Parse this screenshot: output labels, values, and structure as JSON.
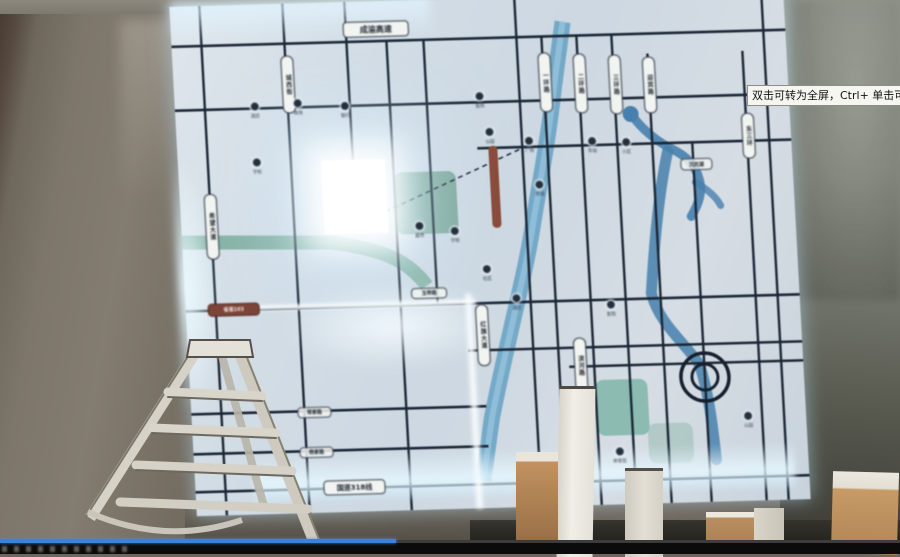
{
  "video_player": {
    "tooltip_text": "双击可转为全屏，Ctrl+ 单击可转为",
    "progress_percent": 44,
    "progress_color": "#3b82d8",
    "track_color": "#3c3c3c",
    "bar_color": "#0b0b0b"
  },
  "map_board": {
    "board_glow_color": "#cfeaff",
    "road_color": "#1b2736",
    "river_color": "#4a85b2",
    "canal_color": "#7fae9f",
    "park_color": "#6e9d8c",
    "red_road_color": "#8a4a3a",
    "site_square_color": "#ffffff",
    "h_plates": [
      {
        "text": "成渝高速",
        "x": 172,
        "y": 20,
        "w": 64,
        "h": 14,
        "style": "plate"
      },
      {
        "text": "省道103",
        "x": 22,
        "y": 298,
        "w": 50,
        "h": 11,
        "style": "red"
      },
      {
        "text": "常家路",
        "x": 106,
        "y": 404,
        "w": 32,
        "h": 9,
        "style": "small"
      },
      {
        "text": "杨家路",
        "x": 106,
        "y": 444,
        "w": 32,
        "h": 9,
        "style": "small"
      },
      {
        "text": "国道318线",
        "x": 128,
        "y": 478,
        "w": 60,
        "h": 13,
        "style": "plate"
      },
      {
        "text": "玉带路",
        "x": 226,
        "y": 288,
        "w": 34,
        "h": 9,
        "style": "small"
      },
      {
        "text": "沉抗湖",
        "x": 502,
        "y": 166,
        "w": 30,
        "h": 10,
        "style": "small"
      }
    ],
    "v_plates": [
      {
        "text": "希望大道",
        "x": 24,
        "y": 188,
        "h": 64
      },
      {
        "text": "城西街",
        "x": 108,
        "y": 52,
        "h": 56
      },
      {
        "text": "一环路",
        "x": 365,
        "y": 56,
        "h": 58
      },
      {
        "text": "二环路",
        "x": 400,
        "y": 58,
        "h": 58
      },
      {
        "text": "三环路",
        "x": 435,
        "y": 60,
        "h": 58
      },
      {
        "text": "迎宾路",
        "x": 469,
        "y": 63,
        "h": 55
      },
      {
        "text": "东三环",
        "x": 565,
        "y": 122,
        "h": 44
      },
      {
        "text": "红旗大道",
        "x": 289,
        "y": 306,
        "h": 60
      },
      {
        "text": "滨河路",
        "x": 385,
        "y": 342,
        "h": 54
      }
    ],
    "markers": [
      {
        "label": "酒店",
        "x": 80,
        "y": 97
      },
      {
        "label": "商场",
        "x": 123,
        "y": 95
      },
      {
        "label": "银行",
        "x": 170,
        "y": 99
      },
      {
        "label": "学校",
        "x": 79,
        "y": 153
      },
      {
        "label": "医院",
        "x": 305,
        "y": 93
      },
      {
        "label": "公园",
        "x": 313,
        "y": 129
      },
      {
        "label": "广场",
        "x": 352,
        "y": 139
      },
      {
        "label": "车站",
        "x": 415,
        "y": 141
      },
      {
        "label": "小区",
        "x": 449,
        "y": 143
      },
      {
        "label": "市场",
        "x": 360,
        "y": 183
      },
      {
        "label": "超市",
        "x": 238,
        "y": 221
      },
      {
        "label": "学校",
        "x": 273,
        "y": 227
      },
      {
        "label": "社区",
        "x": 303,
        "y": 266
      },
      {
        "label": "酒店",
        "x": 331,
        "y": 296
      },
      {
        "label": "影院",
        "x": 425,
        "y": 305
      },
      {
        "label": "体育馆",
        "x": 426,
        "y": 452
      },
      {
        "label": "公园",
        "x": 556,
        "y": 420
      }
    ]
  }
}
